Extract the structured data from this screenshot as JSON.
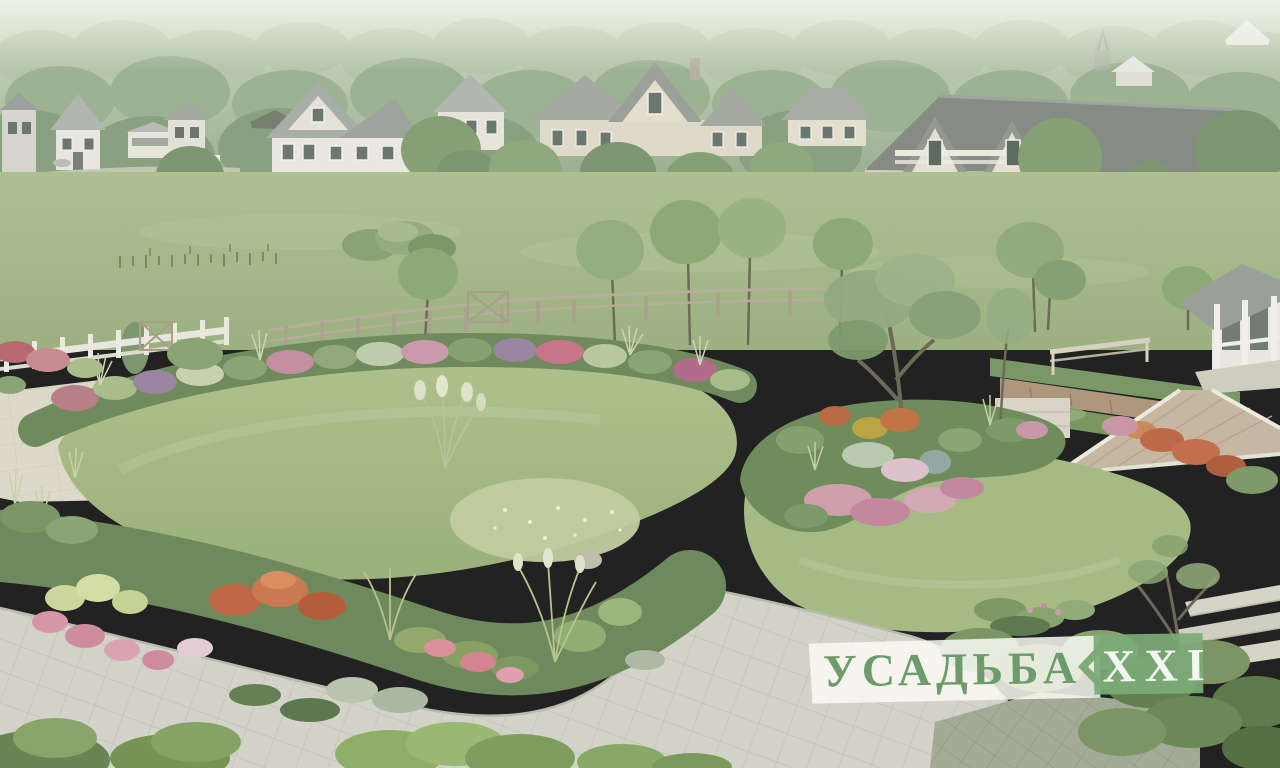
{
  "watermark": {
    "estate_text": "УСАДЬБА",
    "roman_numeral": "XXI",
    "text_color": "#6e9b6c",
    "panel_color": "#7cab77",
    "numeral_color": "#f4f7f0",
    "plate_color": "#f7f7f2"
  },
  "palette": {
    "haze_sky": "#e9ede5",
    "forest_green": "#9fb494",
    "meadow_green": "#a3b789",
    "lawn_green": "#a8bd86",
    "wildflower_patch": "#c3cda2",
    "flower_pink": "#d09fb0",
    "flower_red_orange": "#c4704d",
    "flower_purple": "#9a86a0",
    "pond_water": "#57626a",
    "paver_gray": "#d4d3c9",
    "patio_beige": "#ddd9c9",
    "fence_white": "#e6e5dc",
    "fence_wood": "#b3ab97",
    "roof_gray": "#8f938e",
    "wall_cream": "#e7e4d8"
  }
}
